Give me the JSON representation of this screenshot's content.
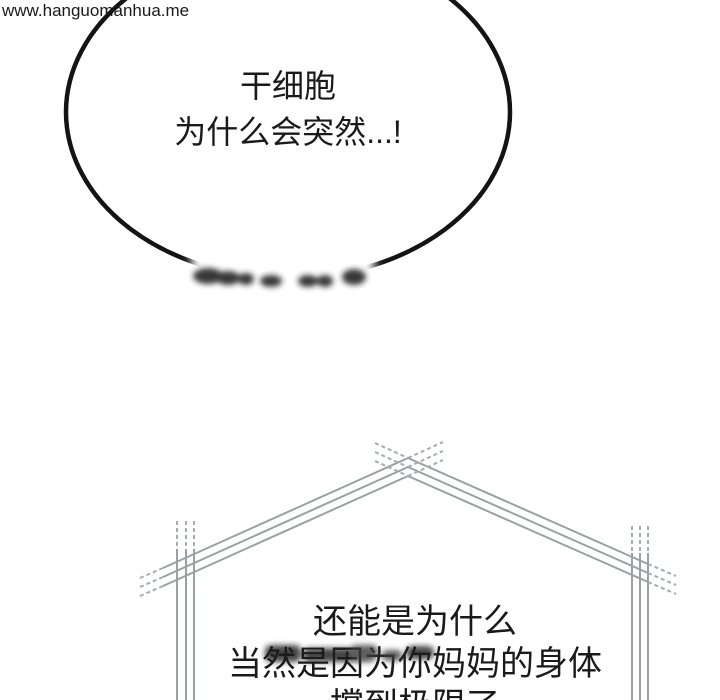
{
  "watermark": {
    "text": "www.hanguomanhua.me"
  },
  "speech_bubble": {
    "line1": "干细胞",
    "line2": "为什么会突然...!"
  },
  "dialogue": {
    "line1": "还能是为什么",
    "line2": "当然是因为你妈妈的身体",
    "line3": "撑到极限了"
  },
  "colors": {
    "background": "#ffffff",
    "ink": "#1a1a1a",
    "bubble_outline": "#141414",
    "sketch_line": "#99a1a4",
    "sketch_line_dash": "#a6adaf",
    "censor_dark": "#1d1d1d",
    "censor_mid": "#3a3a3a"
  }
}
